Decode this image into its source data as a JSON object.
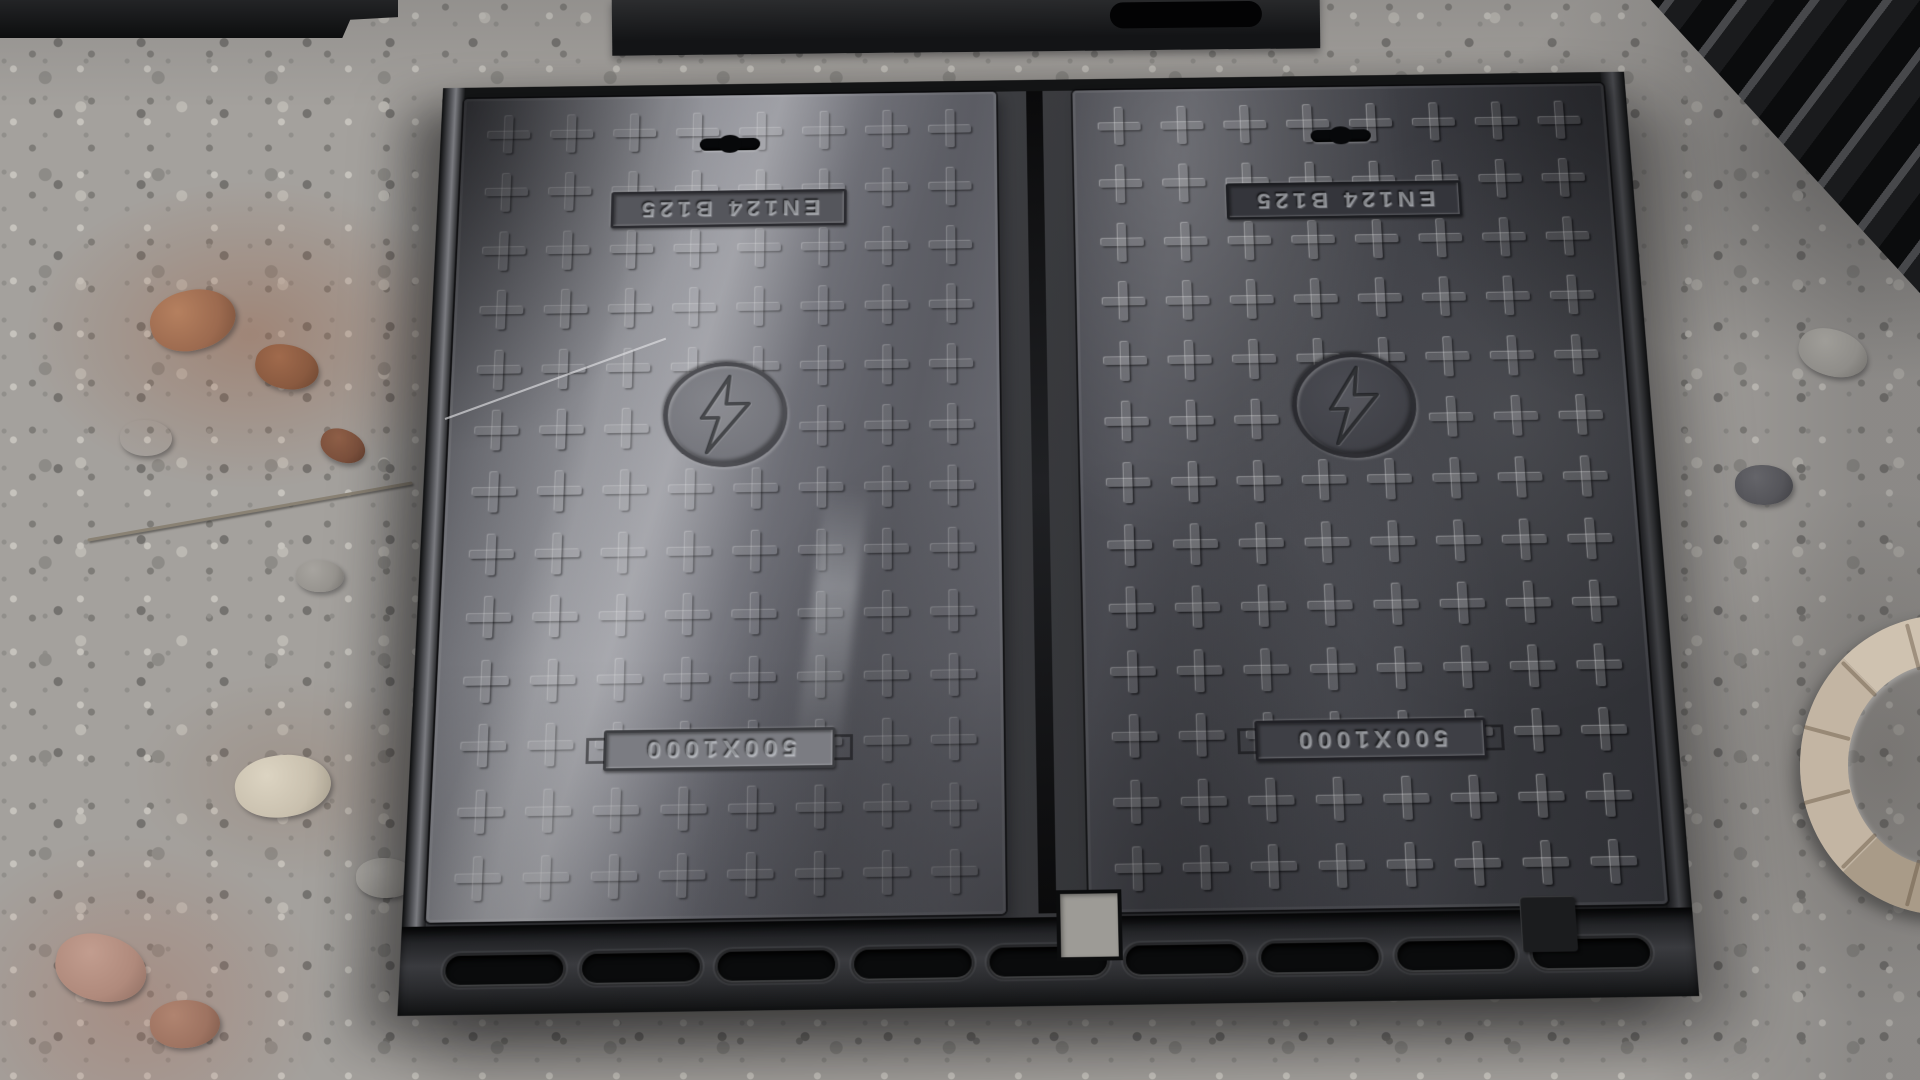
{
  "scene": {
    "description": "Photograph of two rectangular cast-iron electrical manhole covers seated in a common frame, lying on crushed gray gravel with rust-stained stones; more cast-iron covers stacked at top right and a corrugated hose at bottom right",
    "objects": {
      "covers": [
        {
          "id": "left",
          "standard_label": "EN124 B125",
          "size_label": "500X1000",
          "symbol": "lightning-bolt"
        },
        {
          "id": "right",
          "standard_label": "EN124 B125",
          "size_label": "500X1000",
          "symbol": "lightning-bolt"
        }
      ],
      "pattern": {
        "shape": "embossed-cross",
        "columns": 8,
        "rows": 13
      },
      "frame": {
        "slot_count": 9
      },
      "background_items": [
        "gravel-ground",
        "rust-stained-stones",
        "flat-cover-top-left",
        "flat-cover-top-center",
        "stacked-covers-top-right",
        "corrugated-hose-bottom-right",
        "thin-wire-on-cover"
      ]
    },
    "colors": {
      "cover_dark": "#37383d",
      "cover_sheen": "#9b9ca2",
      "frame_dark": "#232427",
      "gravel_base": "#a4a19d",
      "rust_stone": "#9a6a4e",
      "hose": "#c3b5a3",
      "slot_black": "#0a0b0c"
    }
  }
}
